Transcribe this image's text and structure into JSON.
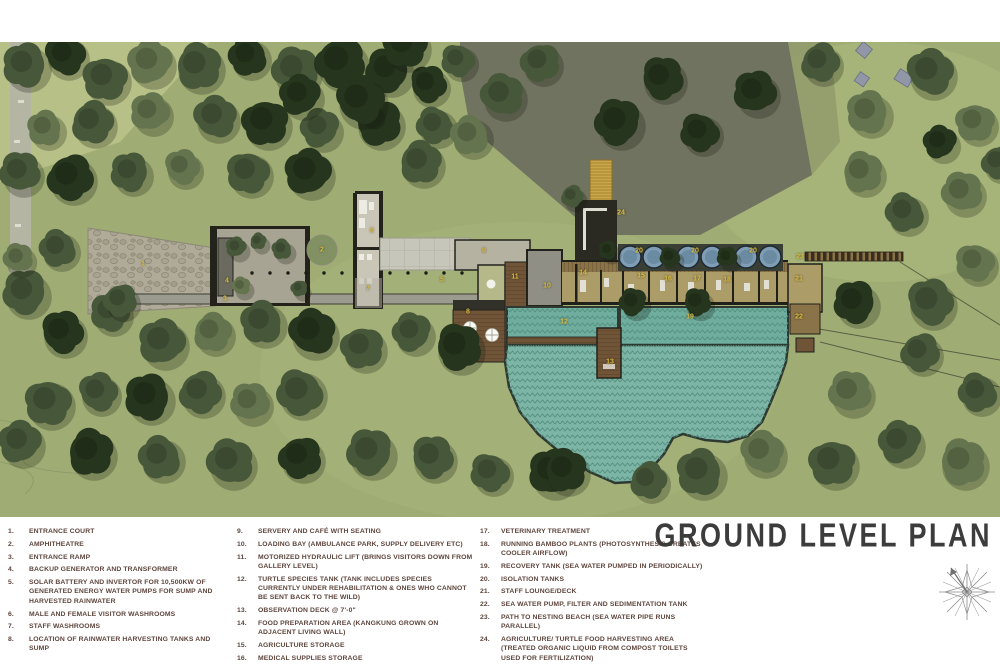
{
  "title": "GROUND LEVEL PLAN",
  "legend": {
    "columns": [
      {
        "items": [
          {
            "num": "1.",
            "text": "ENTRANCE COURT"
          },
          {
            "num": "2.",
            "text": "AMPHITHEATRE"
          },
          {
            "num": "3.",
            "text": "ENTRANCE RAMP"
          },
          {
            "num": "4.",
            "text": "BACKUP GENERATOR AND TRANSFORMER"
          },
          {
            "num": "5.",
            "text": "SOLAR BATTERY AND INVERTOR  FOR 10,500KW OF GENERATED ENERGY WATER PUMPS FOR SUMP AND HARVESTED RAINWATER"
          },
          {
            "num": "6.",
            "text": "MALE AND FEMALE VISITOR WASHROOMS"
          },
          {
            "num": "7.",
            "text": "STAFF WASHROOMS"
          },
          {
            "num": "8.",
            "text": "LOCATION OF RAINWATER HARVESTING TANKS AND SUMP"
          }
        ]
      },
      {
        "items": [
          {
            "num": "9.",
            "text": "SERVERY AND CAFÉ WITH SEATING"
          },
          {
            "num": "10.",
            "text": "LOADING BAY (AMBULANCE PARK, SUPPLY DELIVERY ETC)"
          },
          {
            "num": "11.",
            "text": "MOTORIZED HYDRAULIC LIFT (BRINGS VISITORS DOWN FROM GALLERY LEVEL)"
          },
          {
            "num": "12.",
            "text": "TURTLE SPECIES TANK (TANK INCLUDES SPECIES CURRENTLY UNDER REHABILITATION & ONES WHO CANNOT BE SENT BACK TO THE WILD)"
          },
          {
            "num": "13.",
            "text": "OBSERVATION DECK @ 7'-0\""
          },
          {
            "num": "14.",
            "text": "FOOD PREPARATION AREA (KANGKUNG GROWN ON ADJACENT LIVING WALL)"
          },
          {
            "num": "15.",
            "text": "AGRICULTURE STORAGE"
          },
          {
            "num": "16.",
            "text": "MEDICAL SUPPLIES STORAGE"
          }
        ]
      },
      {
        "items": [
          {
            "num": "17.",
            "text": "VETERINARY TREATMENT"
          },
          {
            "num": "18.",
            "text": "RUNNING BAMBOO PLANTS (PHOTOSYNTHESIS CREATES COOLER AIRFLOW)"
          },
          {
            "num": "19.",
            "text": "RECOVERY TANK (SEA WATER PUMPED IN PERIODICALLY)"
          },
          {
            "num": "20.",
            "text": "ISOLATION TANKS"
          },
          {
            "num": "21.",
            "text": "STAFF LOUNGE/DECK"
          },
          {
            "num": "22.",
            "text": "SEA WATER PUMP, FILTER AND SEDIMENTATION TANK"
          },
          {
            "num": "23.",
            "text": "PATH TO NESTING BEACH (SEA WATER PIPE RUNS PARALLEL)"
          },
          {
            "num": "24.",
            "text": "AGRICULTURE/ TURTLE FOOD HARVESTING AREA (TREATED ORGANIC LIQUID FROM COMPOST TOILETS USED FOR FERTILIZATION)"
          }
        ]
      }
    ]
  },
  "plan": {
    "markers": [
      {
        "label": "1",
        "x": 143,
        "y": 222
      },
      {
        "label": "2",
        "x": 322,
        "y": 208
      },
      {
        "label": "3",
        "x": 225,
        "y": 257
      },
      {
        "label": "4",
        "x": 227,
        "y": 239
      },
      {
        "label": "5",
        "x": 442,
        "y": 238
      },
      {
        "label": "6",
        "x": 372,
        "y": 189
      },
      {
        "label": "7",
        "x": 368,
        "y": 247
      },
      {
        "label": "8",
        "x": 468,
        "y": 270
      },
      {
        "label": "9",
        "x": 484,
        "y": 209
      },
      {
        "label": "10",
        "x": 547,
        "y": 244
      },
      {
        "label": "11",
        "x": 515,
        "y": 235
      },
      {
        "label": "12",
        "x": 564,
        "y": 280
      },
      {
        "label": "13",
        "x": 610,
        "y": 320
      },
      {
        "label": "14",
        "x": 583,
        "y": 231
      },
      {
        "label": "15",
        "x": 641,
        "y": 234
      },
      {
        "label": "16",
        "x": 668,
        "y": 237
      },
      {
        "label": "17",
        "x": 697,
        "y": 237
      },
      {
        "label": "18",
        "x": 727,
        "y": 238
      },
      {
        "label": "19",
        "x": 690,
        "y": 275
      },
      {
        "label": "20",
        "x": 639,
        "y": 209
      },
      {
        "label": "20",
        "x": 695,
        "y": 209
      },
      {
        "label": "20",
        "x": 753,
        "y": 209
      },
      {
        "label": "21",
        "x": 799,
        "y": 237
      },
      {
        "label": "22",
        "x": 799,
        "y": 275
      },
      {
        "label": "23",
        "x": 800,
        "y": 215
      },
      {
        "label": "24",
        "x": 621,
        "y": 171
      }
    ],
    "colors": {
      "marker_yellow": "#DCBE3E",
      "water_teal": "#7CB4A6",
      "legend_text": "#5D453C",
      "title_text": "#3C3C3C",
      "meadow_green": "#9FAD74",
      "dark_canopy": "#26351D"
    }
  }
}
